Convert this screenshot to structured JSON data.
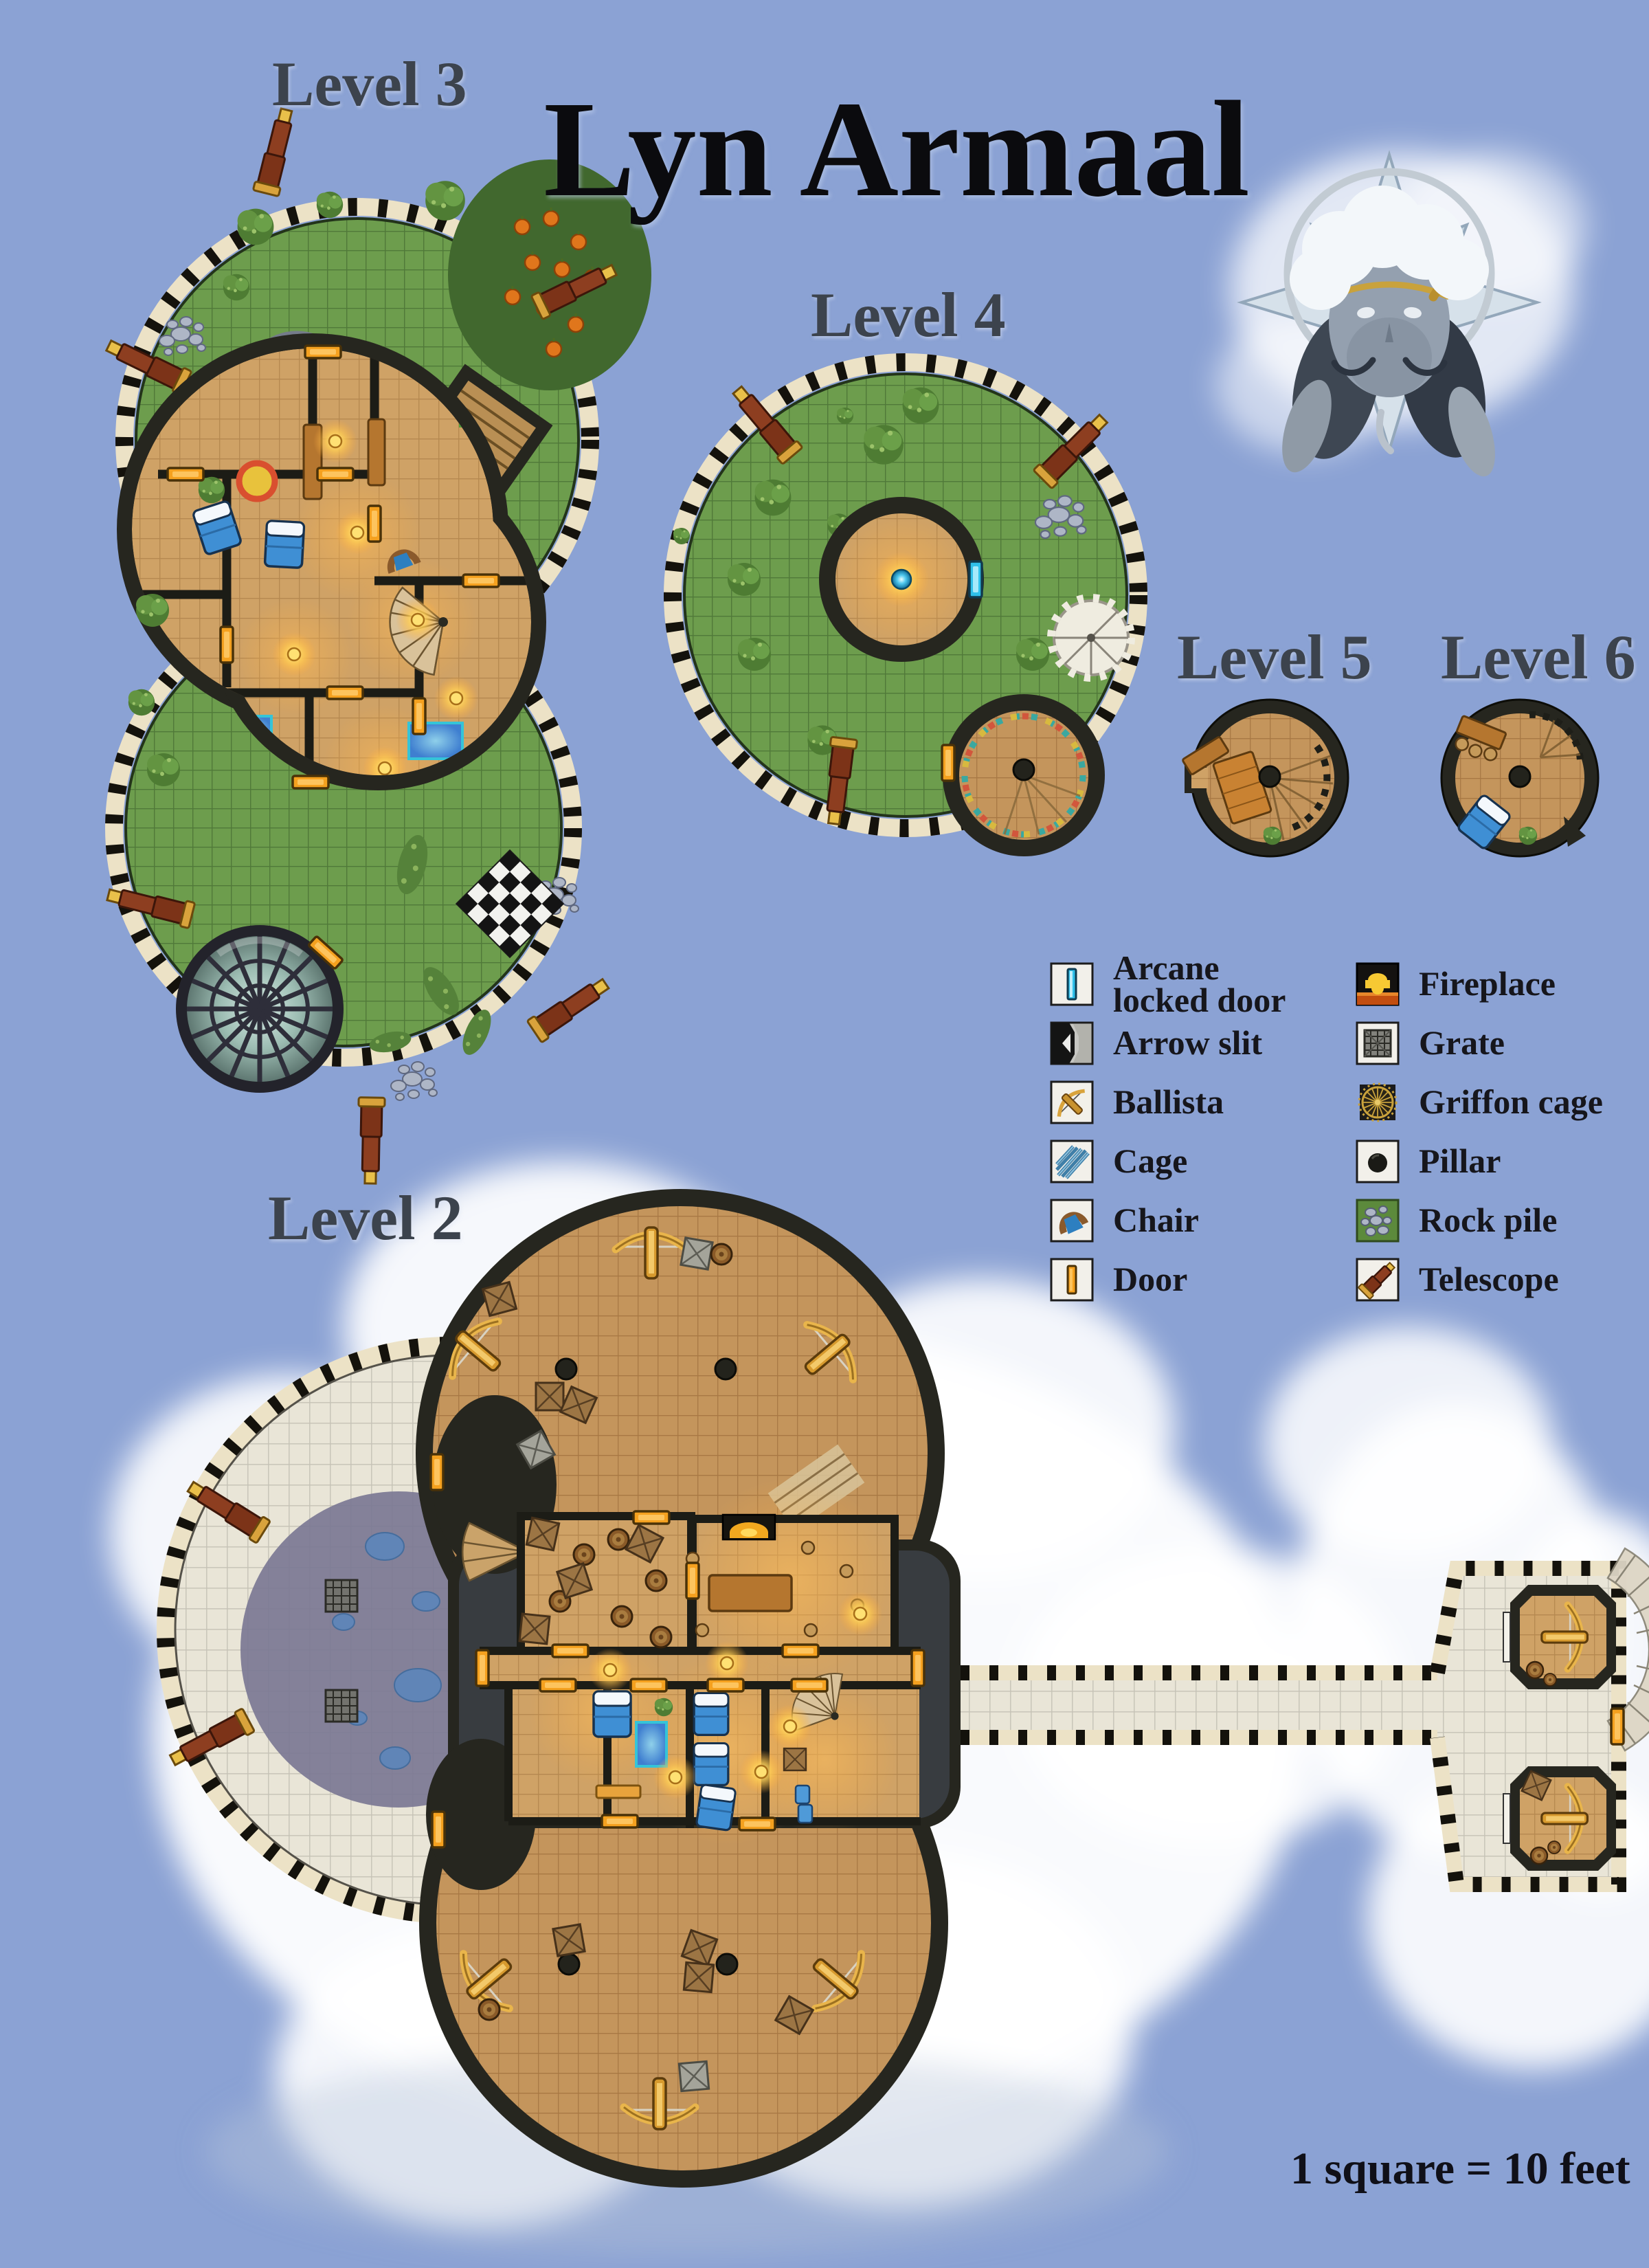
{
  "page": {
    "title": "Lyn Armaal",
    "scale_note": "1 square = 10 feet",
    "background_color": "#8ba2d4"
  },
  "levels": [
    {
      "id": "level-2",
      "label": "Level 2"
    },
    {
      "id": "level-3",
      "label": "Level 3"
    },
    {
      "id": "level-4",
      "label": "Level 4"
    },
    {
      "id": "level-5",
      "label": "Level 5"
    },
    {
      "id": "level-6",
      "label": "Level 6"
    }
  ],
  "legend": {
    "columns": [
      {
        "items": [
          {
            "icon": "arcane-locked-door",
            "label": "Arcane\nlocked door"
          },
          {
            "icon": "arrow-slit",
            "label": "Arrow slit"
          },
          {
            "icon": "ballista",
            "label": "Ballista"
          },
          {
            "icon": "cage",
            "label": "Cage"
          },
          {
            "icon": "chair",
            "label": "Chair"
          },
          {
            "icon": "door",
            "label": "Door"
          }
        ]
      },
      {
        "items": [
          {
            "icon": "fireplace",
            "label": "Fireplace"
          },
          {
            "icon": "grate",
            "label": "Grate"
          },
          {
            "icon": "griffon-cage",
            "label": "Griffon cage"
          },
          {
            "icon": "pillar",
            "label": "Pillar"
          },
          {
            "icon": "rock-pile",
            "label": "Rock pile"
          },
          {
            "icon": "telescope",
            "label": "Telescope"
          }
        ]
      }
    ]
  },
  "colors": {
    "background": "#8ba2d4",
    "cloud": "#ffffff",
    "battlement_cream": "#ece2c6",
    "wall_dark": "#26261f",
    "grass": "#6d9d4d",
    "wood_deck": "#c4955c",
    "wood_interior": "#cfa266",
    "stone": "#e9e5d7",
    "shadow_purple": "#7b7894",
    "water_blue": "#4f86d0",
    "door_orange": "#f5a11f",
    "arcane_door_cyan": "#2fc0ea",
    "gold": "#d9a33c",
    "label_color": "#3c434d",
    "title_color": "#0b0b0e"
  }
}
